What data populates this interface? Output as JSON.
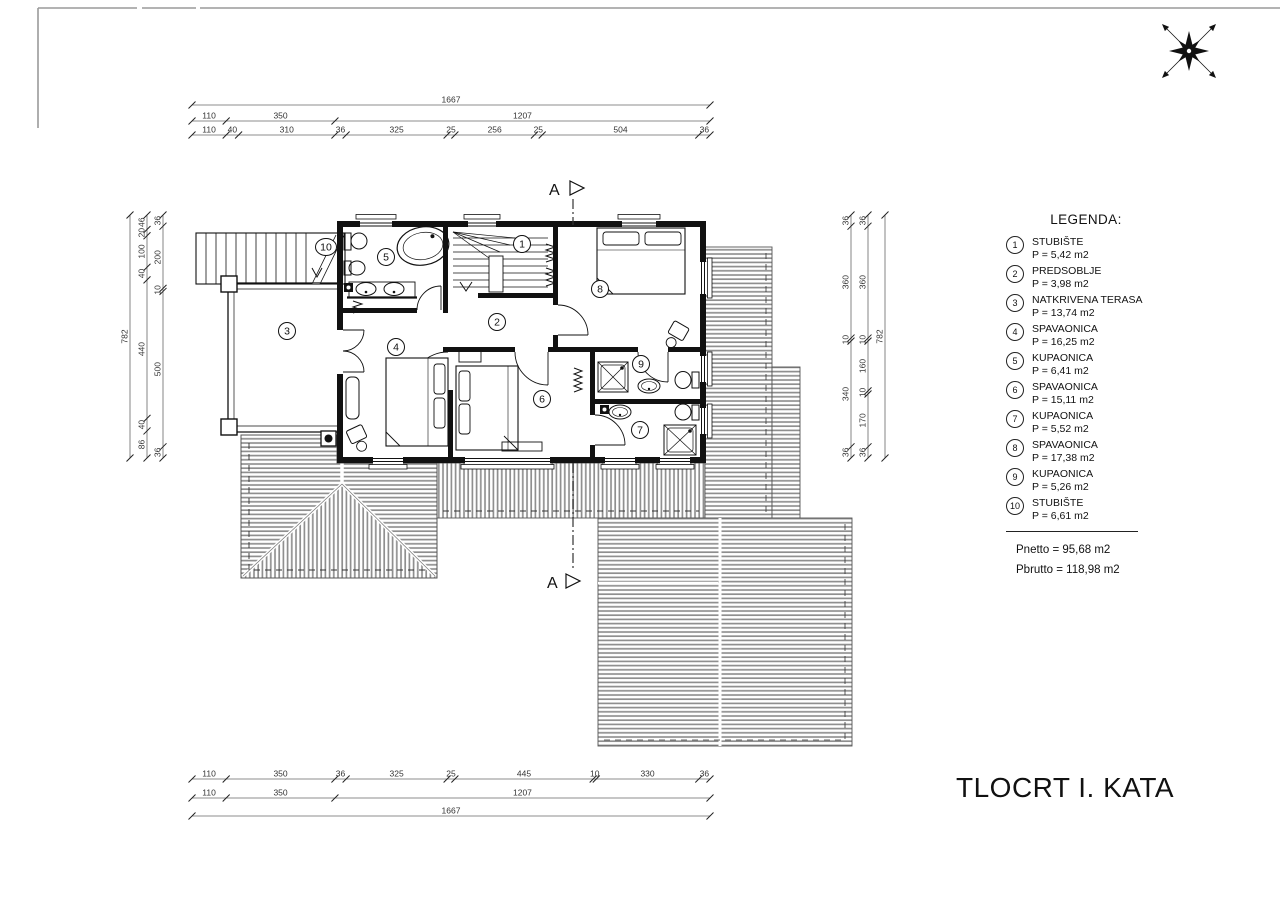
{
  "page": {
    "title": "TLOCRT I. KATA"
  },
  "legend": {
    "title": "LEGENDA:",
    "items": [
      {
        "num": "1",
        "name": "STUBIŠTE",
        "area": "P = 5,42 m2"
      },
      {
        "num": "2",
        "name": "PREDSOBLJE",
        "area": "P = 3,98 m2"
      },
      {
        "num": "3",
        "name": "NATKRIVENA TERASA",
        "area": "P = 13,74 m2"
      },
      {
        "num": "4",
        "name": "SPAVAONICA",
        "area": "P = 16,25 m2"
      },
      {
        "num": "5",
        "name": "KUPAONICA",
        "area": "P = 6,41 m2"
      },
      {
        "num": "6",
        "name": "SPAVAONICA",
        "area": "P = 15,11 m2"
      },
      {
        "num": "7",
        "name": "KUPAONICA",
        "area": "P = 5,52 m2"
      },
      {
        "num": "8",
        "name": "SPAVAONICA",
        "area": "P = 17,38 m2"
      },
      {
        "num": "9",
        "name": "KUPAONICA",
        "area": "P = 5,26 m2"
      },
      {
        "num": "10",
        "name": "STUBIŠTE",
        "area": "P = 6,61 m2"
      }
    ],
    "totals": {
      "pnetto": "Pnetto = 95,68 m2",
      "pbrutto": "Pbrutto = 118,98 m2"
    }
  },
  "section": {
    "label": "A"
  },
  "plan": {
    "room_labels": [
      "1",
      "2",
      "3",
      "4",
      "5",
      "6",
      "7",
      "8",
      "9",
      "10"
    ]
  },
  "dimensions": {
    "top_total": [
      "1667"
    ],
    "top_mid": [
      "110",
      "350",
      "1207"
    ],
    "top_detail": [
      "110",
      "40",
      "310",
      "36",
      "325",
      "25",
      "256",
      "25",
      "504",
      "36"
    ],
    "bottom_detail": [
      "110",
      "350",
      "36",
      "325",
      "25",
      "445",
      "10",
      "330",
      "36"
    ],
    "bottom_mid": [
      "110",
      "350",
      "1207"
    ],
    "bottom_total": [
      "1667"
    ],
    "left_total": [
      "782"
    ],
    "left_detail": [
      "46",
      "20",
      "100",
      "40",
      "440",
      "40",
      "86"
    ],
    "left_inner": [
      "36",
      "200",
      "10",
      "500",
      "36"
    ],
    "right_inner": [
      "36",
      "360",
      "10",
      "340",
      "36"
    ],
    "right_detail": [
      "36",
      "360",
      "10",
      "160",
      "10",
      "170",
      "36"
    ],
    "right_total": [
      "782"
    ]
  }
}
